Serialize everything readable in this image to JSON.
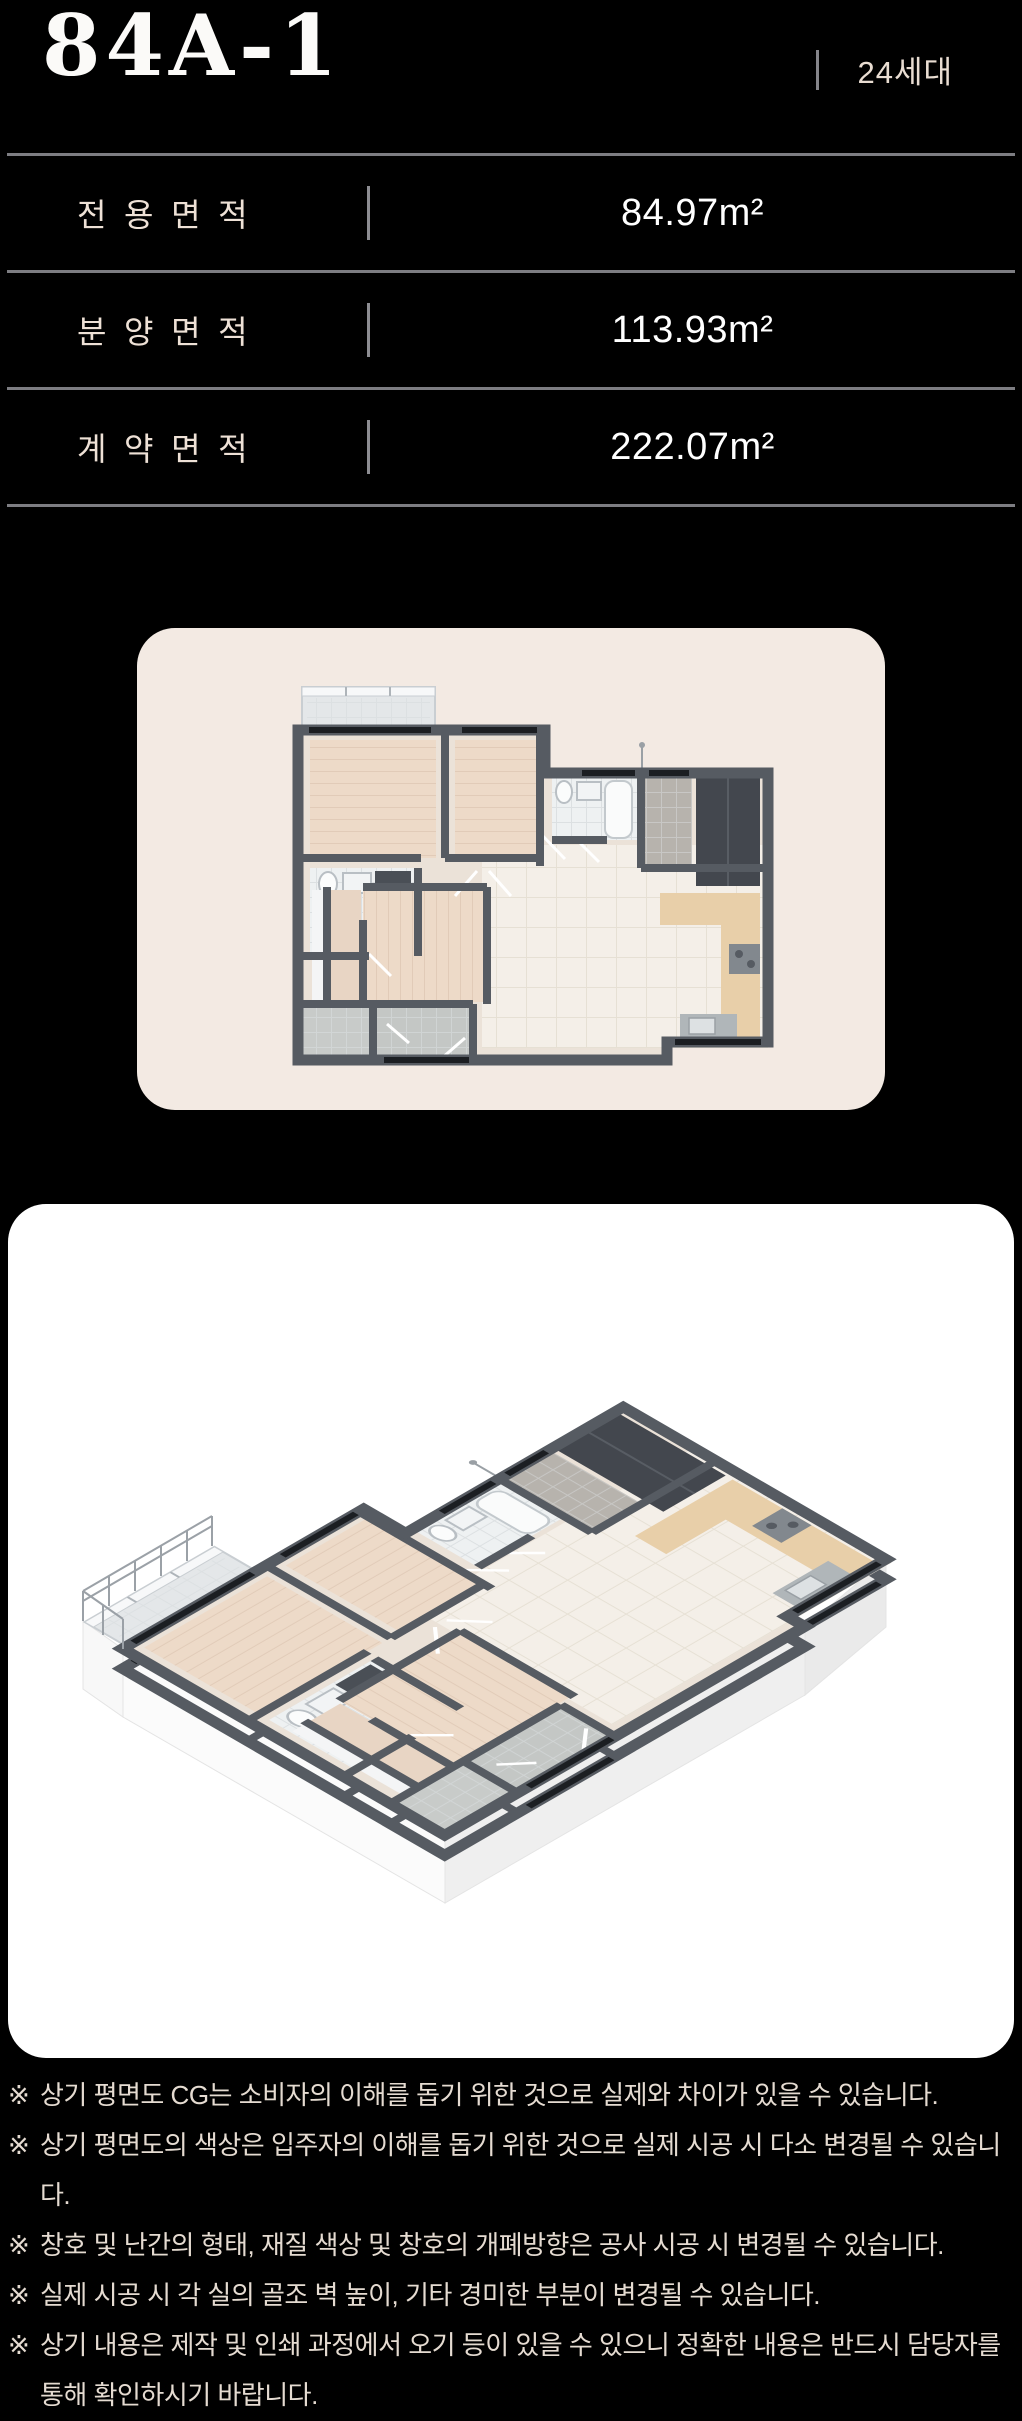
{
  "header": {
    "unit_type": "84A-1",
    "units_label": "24세대"
  },
  "area_table": {
    "rows": [
      {
        "label": "전용면적",
        "value": "84.97m²"
      },
      {
        "label": "분양면적",
        "value": "113.93m²"
      },
      {
        "label": "계약면적",
        "value": "222.07m²"
      }
    ]
  },
  "disclaimer": {
    "marker": "※",
    "items": [
      "상기 평면도 CG는 소비자의 이해를 돕기 위한 것으로 실제와 차이가 있을 수 있습니다.",
      "상기 평면도의 색상은 입주자의 이해를 돕기 위한 것으로 실제 시공 시 다소 변경될 수 있습니다.",
      "창호 및 난간의 형태, 재질 색상 및 창호의 개폐방향은 공사 시공 시 변경될 수 있습니다.",
      "실제 시공 시 각 실의 골조 벽 높이, 기타 경미한 부분이 변경될 수 있습니다.",
      "상기 내용은 제작 및 인쇄 과정에서 오기 등이 있을 수 있으니 정확한 내용은 반드시 담당자를 통해 확인하시기 바랍니다."
    ]
  },
  "colors": {
    "background": "#000000",
    "rule_gray": "#7d7d82",
    "text_cream": "#e5dbd1",
    "title_white": "#fbfaf8",
    "card_cream": "#f3eae3",
    "card_white": "#ffffff",
    "wall_gray": "#565b62",
    "floor_hall": "#ebe2d8",
    "floor_bedroom": "#eddac8",
    "floor_living": "#f4efe8",
    "floor_bath": "#eef1f2",
    "counter_beige": "#e8cfa9",
    "window_black": "#1b1e22"
  }
}
